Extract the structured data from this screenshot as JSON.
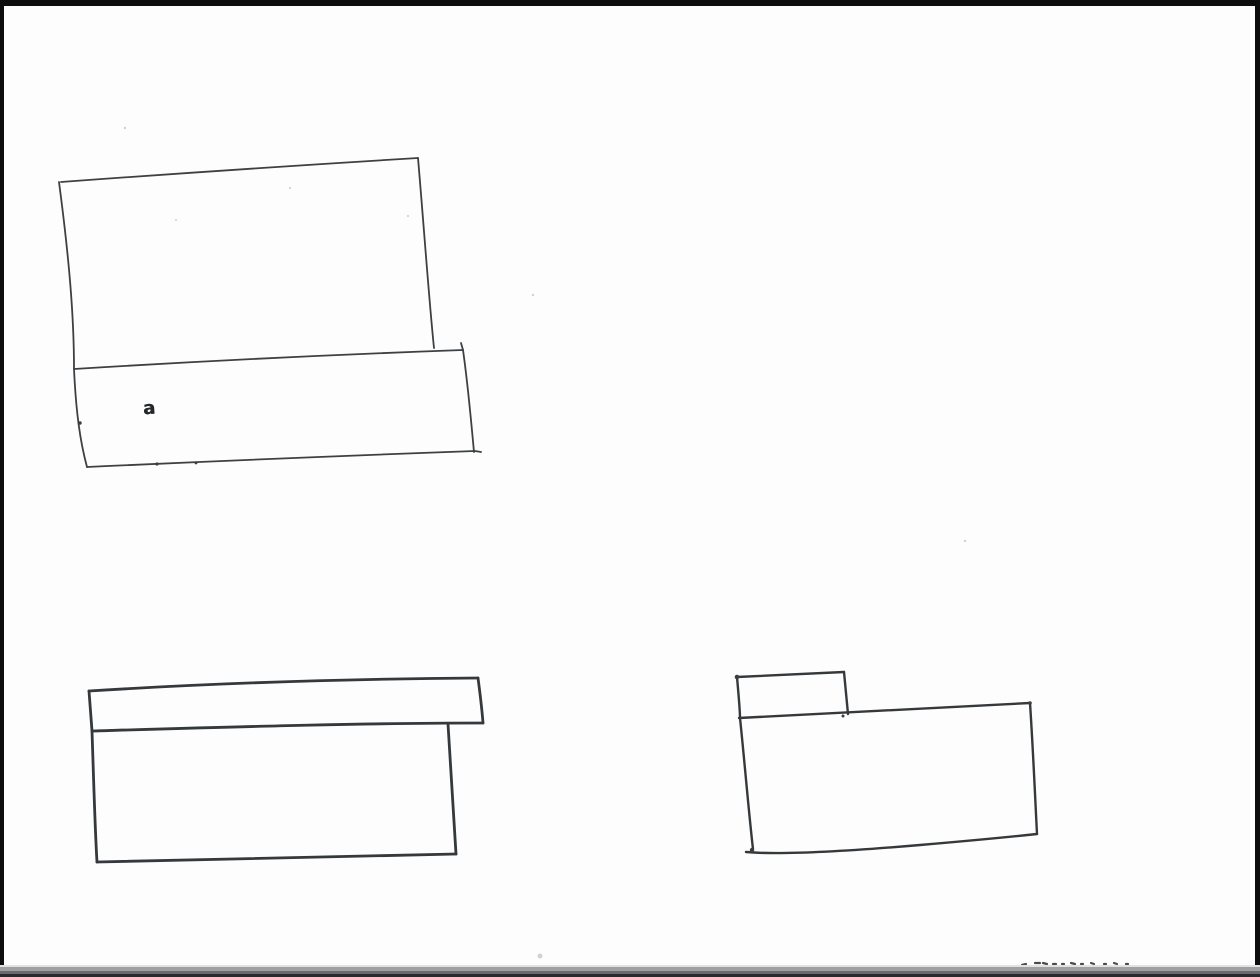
{
  "document": {
    "kind": "scanned hand-drawn pen sketch of three box shapes",
    "paper_color": "#fdfdfd",
    "ink_color": "#3a3e41",
    "scribble_ink_color": "#24282b",
    "speck_color": "#d2d2d2",
    "border": {
      "top_color": "#0d0d0d",
      "left_color": "#0d0d0d",
      "right_color": "#0d0d0d",
      "bottom_layer_colors": [
        "#e2e2e2",
        "#9fa0a2",
        "#6a6a6c",
        "#2a2a2c"
      ]
    }
  },
  "sketch": {
    "scribble": {
      "text": "a"
    },
    "shapes": [
      {
        "name": "open-box-sketch-top-left",
        "stroke_width": 1.8,
        "color": "#3d4144",
        "paths": [
          "M61,182 Q238,169 418,158",
          "M418,158 C424,228 429,300 434,348",
          "M59,182 C69,258 74,315 74,369 C76,412 80,441 87,467",
          "M74,369 Q268,357 463,350",
          "M463,350 L461,343",
          "M463,350 C468,385 471,420 474,452",
          "M87,467 Q282,458 475,451 L481,452"
        ]
      },
      {
        "name": "lidded-box-sketch-bottom-left",
        "stroke_width": 2.8,
        "color": "#35393c",
        "paths": [
          "M89,691 C200,684 340,679 478,678",
          "M89,691 L92,731",
          "M92,731 C230,727 360,723 483,723",
          "M478,678 C480,693 482,710 483,723",
          "M92,731 C94,790 95,830 97,862",
          "M97,862 Q270,858 456,854",
          "M448,724 C451,770 454,815 456,854"
        ]
      },
      {
        "name": "tabbed-box-sketch-bottom-right",
        "stroke_width": 2.4,
        "color": "#36393c",
        "paths": [
          "M737,677 L844,672",
          "M737,677 C739,700 740,710 740,718 C745,766 749,815 753,849",
          "M844,672 L848,714",
          "M739,718 C840,713 940,708 1030,703",
          "M1030,703 C1033,748 1035,795 1037,834",
          "M746,852 C780,855 850,851 920,845 Q990,839 1037,834"
        ]
      }
    ],
    "ink_dots": [
      {
        "cx": 80,
        "cy": 423,
        "r": 1.7
      },
      {
        "cx": 157,
        "cy": 464,
        "r": 1.6
      },
      {
        "cx": 196,
        "cy": 463,
        "r": 1.4
      },
      {
        "cx": 737,
        "cy": 677,
        "r": 2.3
      },
      {
        "cx": 843,
        "cy": 716,
        "r": 1.5
      },
      {
        "cx": 752,
        "cy": 850,
        "r": 2.2
      },
      {
        "cx": 1030,
        "cy": 703,
        "r": 1.8
      }
    ],
    "footer_marks": {
      "description": "tops of handwriting cut off by bottom scan border",
      "color": "#4b4b4d",
      "stroke_width": 2.2,
      "paths": [
        "M1022,965 L1026,964",
        "M1035,963 L1040,963",
        "M1043,963 L1047,964",
        "M1053,964 L1056,964",
        "M1062,964 L1064,964",
        "M1071,963 L1075,964",
        "M1081,964 L1083,964",
        "M1091,963 L1094,964",
        "M1104,964 L1106,964",
        "M1114,963 L1117,964",
        "M1126,964 L1128,964"
      ]
    },
    "specks": [
      {
        "cx": 125,
        "cy": 128,
        "r": 1.2
      },
      {
        "cx": 290,
        "cy": 188,
        "r": 1.1
      },
      {
        "cx": 408,
        "cy": 216,
        "r": 1.1
      },
      {
        "cx": 533,
        "cy": 295,
        "r": 1.2
      },
      {
        "cx": 176,
        "cy": 220,
        "r": 1.0
      },
      {
        "cx": 965,
        "cy": 541,
        "r": 1.2
      },
      {
        "cx": 540,
        "cy": 956,
        "r": 2.5
      }
    ]
  }
}
